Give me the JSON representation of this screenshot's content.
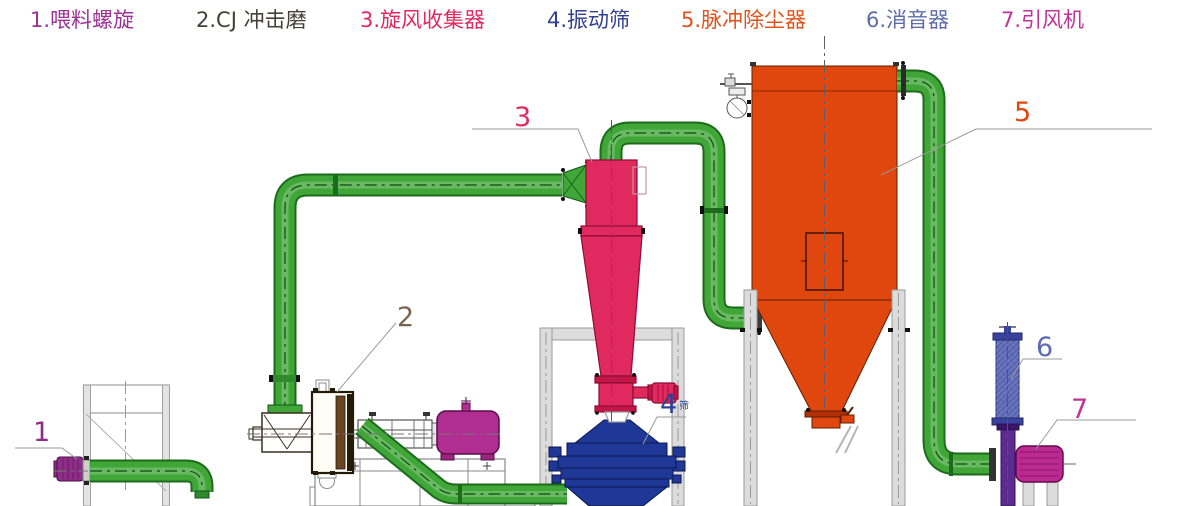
{
  "legend": {
    "items": [
      {
        "label": "1.喂料螺旋",
        "color": "#9b3393"
      },
      {
        "label": "2.CJ 冲击磨",
        "color": "#454038"
      },
      {
        "label": "3.旋风收集器",
        "color": "#e02a5f"
      },
      {
        "label": "4.振动筛",
        "color": "#333f8f"
      },
      {
        "label": "5.脉冲除尘器",
        "color": "#e0541c"
      },
      {
        "label": "6.消音器",
        "color": "#5f6cab"
      },
      {
        "label": "7.引风机",
        "color": "#c23397"
      }
    ]
  },
  "callouts": [
    {
      "num": "1",
      "color": "#8e2d87"
    },
    {
      "num": "2",
      "color": "#7a6650"
    },
    {
      "num": "3",
      "color": "#e02a5f"
    },
    {
      "num": "4",
      "color": "#2e3f96",
      "suffix": "筛"
    },
    {
      "num": "5",
      "color": "#e0470f"
    },
    {
      "num": "6",
      "color": "#5d68b5"
    },
    {
      "num": "7",
      "color": "#c03397"
    }
  ],
  "colors": {
    "pipe": "#3fa637",
    "pipe_dark": "#1c6b1c",
    "pipe_centerline": "#0e4a11",
    "cyclone": "#e02a5f",
    "cyclone_dark": "#8c0c32",
    "dust_collector": "#e0470f",
    "vibrating_screen": "#1f3796",
    "mill_motor": "#b02d92",
    "feed_motor": "#8e2d87",
    "muffler": "#5d68b5",
    "duct": "#5b2b90",
    "fan": "#bb2a90",
    "structure_fill": "#dcdcdc",
    "structure_line": "#9a9a9a"
  }
}
